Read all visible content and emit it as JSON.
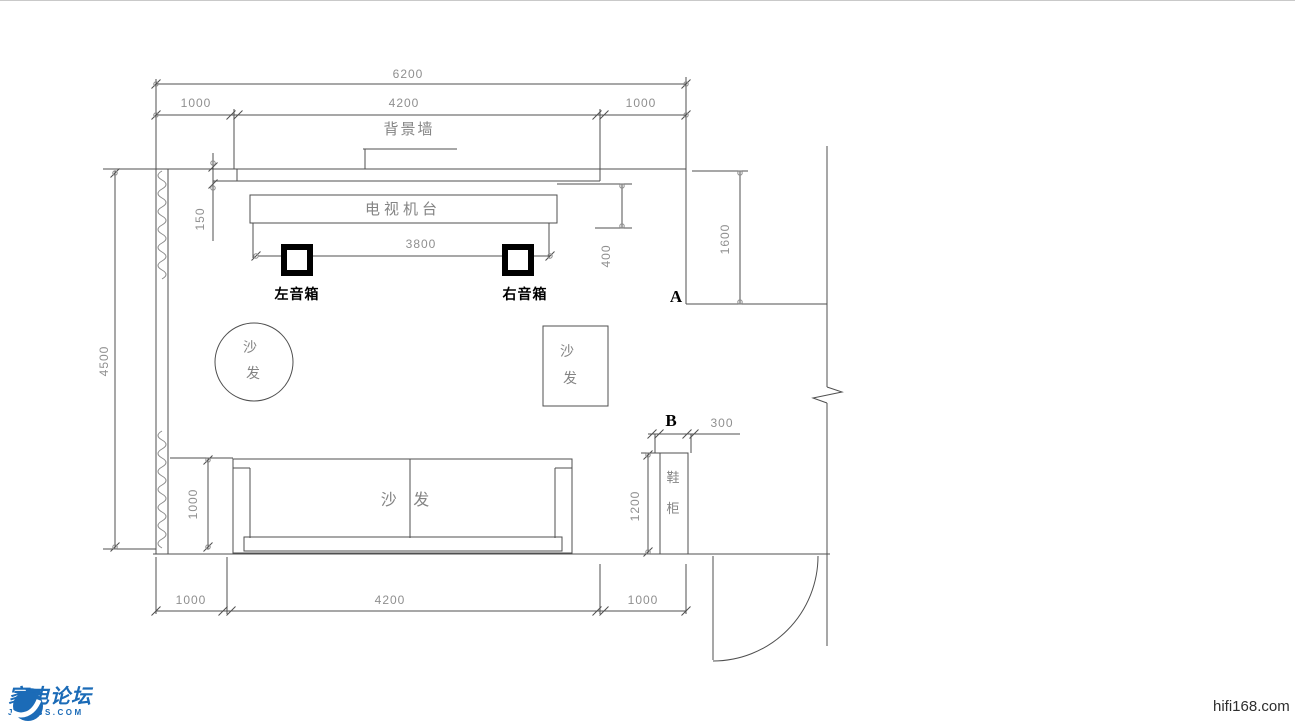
{
  "drawing": {
    "dims": {
      "d6200": "6200",
      "d1000_top_left": "1000",
      "d4200_top": "4200",
      "d1000_top_right": "1000",
      "d4500": "4500",
      "d150": "150",
      "d3800": "3800",
      "d400": "400",
      "d1600": "1600",
      "d1000_sofa": "1000",
      "d1200_cabinet": "1200",
      "d300_cabinet": "300",
      "d1000_bottom_left": "1000",
      "d4200_bottom": "4200",
      "d1000_bottom_right": "1000"
    },
    "labels": {
      "bg_wall": "背景墙",
      "tv_stand": "电视机台",
      "speaker_left": "左音箱",
      "speaker_right": "右音箱",
      "sofa_char1": "沙",
      "sofa_char2": "发",
      "sofa_main": "沙 发",
      "cabinet_char1": "鞋",
      "cabinet_char2": "柜",
      "marker_a": "A",
      "marker_b": "B"
    }
  },
  "footer": {
    "site_name": "家电论坛",
    "site_domain": "JD-BBS.COM",
    "watermark": "hifi168.com"
  },
  "colors": {
    "line": "#4f4f4f",
    "window_wave": "#8a8a8a",
    "dim_text": "#8f8f8f",
    "cad_text": "#848484",
    "marker_text": "#000000",
    "logo_blue": "#1b6bb7",
    "watermark_text": "#2e2e2e"
  }
}
